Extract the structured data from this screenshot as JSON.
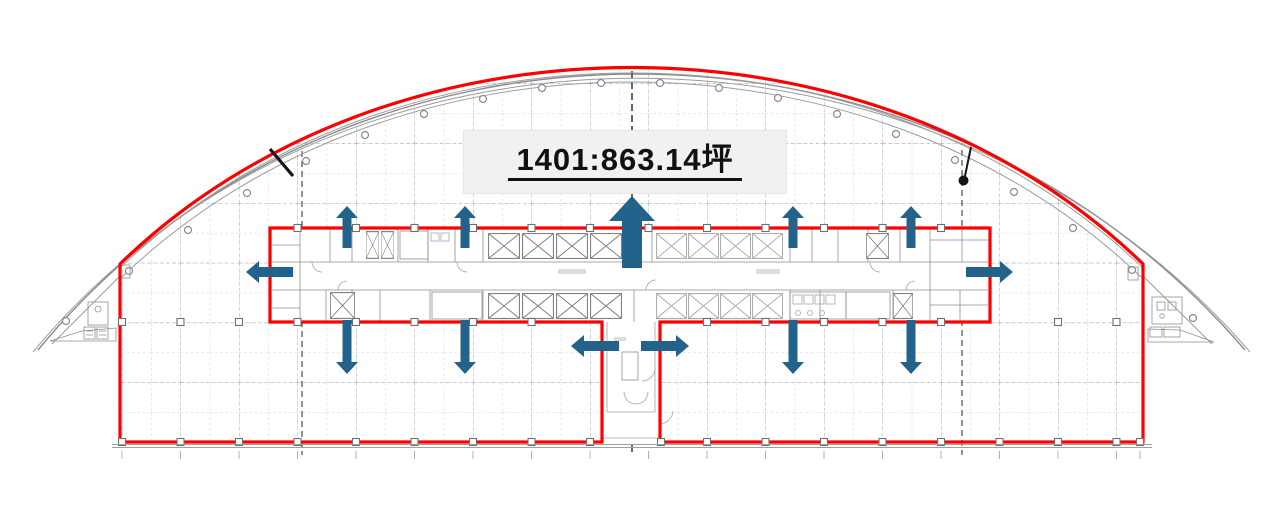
{
  "page": {
    "background": "#ffffff"
  },
  "floorplan": {
    "area_label": {
      "text": "1401:863.14坪",
      "unit_number": "1401",
      "area_value": "863.14",
      "area_unit": "坪"
    },
    "colors": {
      "leasable_boundary": "#fe0000",
      "direction_arrows": "#23638b",
      "label_background": "#f1f1f1",
      "label_text": "#111111",
      "grid_lines": "#c0c4cc",
      "drawing_lines": "#8f8f8f"
    },
    "direction_arrows": {
      "up_count": 5,
      "down_count": 4,
      "left_count": 2,
      "right_count": 2
    }
  }
}
